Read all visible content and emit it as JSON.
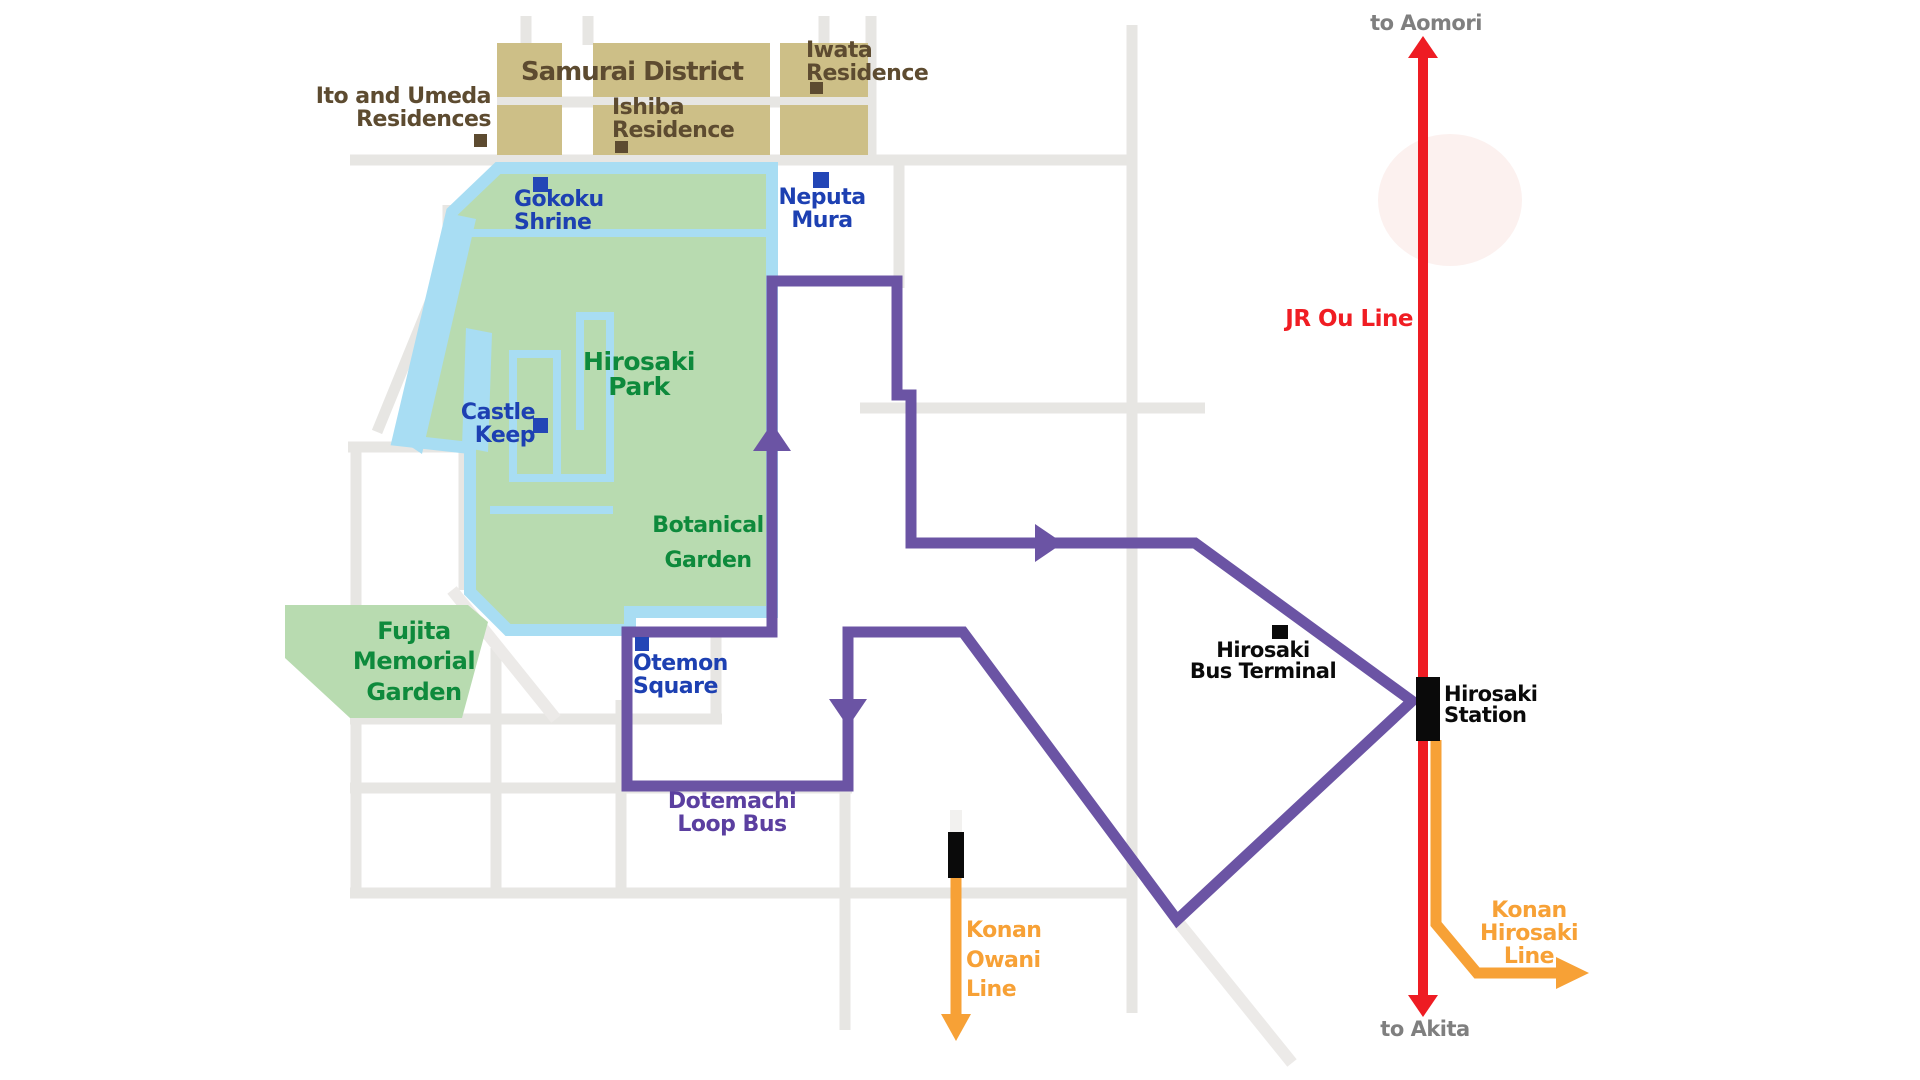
{
  "map_title": "Hirosaki area tourist and transit map",
  "labels": {
    "samurai_district": "Samurai District",
    "ito_umeda_residences": "Ito and Umeda\nResidences",
    "ishiba_residence": "Ishiba\nResidence",
    "iwata_residence": "Iwata\nResidence",
    "gokoku_shrine": "Gokoku\nShrine",
    "neputa_mura": "Neputa\nMura",
    "hirosaki_park": "Hirosaki\nPark",
    "castle_keep": "Castle\nKeep",
    "botanical_garden": "Botanical\nGarden",
    "fujita_memorial_garden": "Fujita\nMemorial\nGarden",
    "otemon_square": "Otemon\nSquare",
    "dotemachi_loop_bus": "Dotemachi\nLoop Bus",
    "hirosaki_bus_terminal": "Hirosaki\nBus Terminal",
    "hirosaki_station": "Hirosaki\nStation",
    "jr_ou_line": "JR Ou Line",
    "to_aomori": "to Aomori",
    "to_akita": "to Akita",
    "konan_owani_line": "Konan\nOwani\nLine",
    "konan_hirosaki_line": "Konan\nHirosaki\nLine"
  },
  "colors": {
    "park_green": "#b8dbb0",
    "water_blue": "#a8ddf3",
    "district_tan": "#cdbf87",
    "loop_bus_purple": "#6b54a4",
    "jr_line_red": "#ee1c23",
    "konan_line_orange": "#f7a136",
    "road_gray": "#e7e6e3",
    "label_blue": "#1d40b2",
    "label_green": "#0e8a3c",
    "label_brown": "#5d4b30",
    "label_purple": "#5b3fa0",
    "label_gray": "#7f7f7f",
    "marker_blue": "#2346b6",
    "marker_brown": "#5d4b30",
    "marker_black": "#0a0a0a"
  }
}
